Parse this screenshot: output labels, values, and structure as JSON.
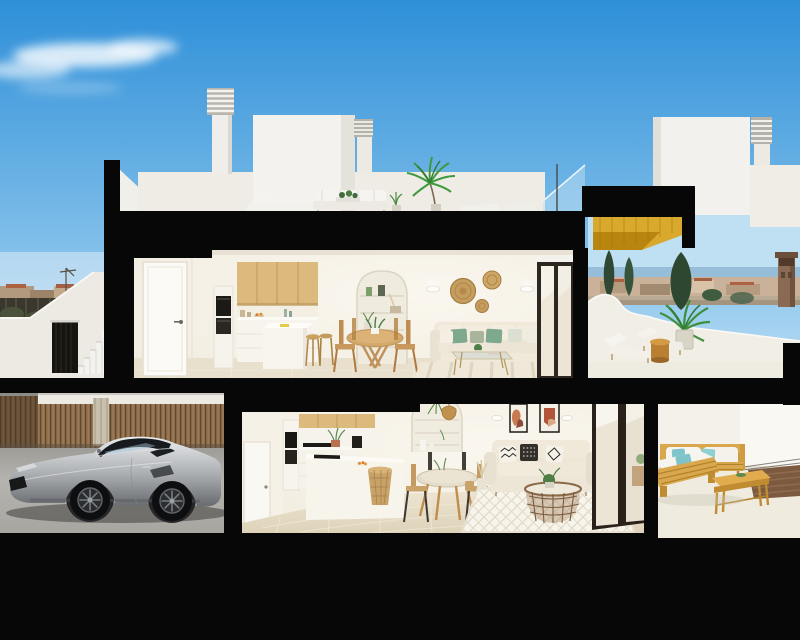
{
  "title": "Cross-section 3D render of a two-storey coastal apartment building",
  "palette": {
    "sky_top": "#2e8fd8",
    "sky_mid": "#7dbde9",
    "sky_horizon": "#cfe9f7",
    "structure_black": "#070707",
    "wall_cream": "#f2ede1",
    "wall_white": "#f3f1ea",
    "wood_cabinet": "#dcba7e",
    "pergola_gold": "#d9a92e",
    "terrace_wood": "#d9a84e",
    "teal_cushion": "#7fc4c9",
    "sage_cushion": "#7fa98f",
    "rattan": "#c49d5e",
    "car_silver": "#b9bcbe",
    "floor_beige": "#e6ddc8",
    "fence_wood": "#8d6c4a",
    "tree_green": "#2e4833",
    "sea_blue": "#8fb7d4",
    "town_tan": "#b29a7f",
    "terracotta_roof": "#ad6142"
  },
  "scene": {
    "sky": {
      "clouds": [
        "wispy-cloud-upper-left",
        "faint-streak"
      ]
    },
    "rooftop": {
      "objects": [
        "louvered-chimney",
        "louvered-chimney",
        "stair-bulkhead-volume",
        "roof-terrace-lounger",
        "roof-terrace-sofa",
        "potted-plant",
        "palm-plant",
        "glass-railing",
        "louvered-chimney-right-unit"
      ]
    },
    "upper_floor": {
      "rooms": [
        "kitchen",
        "dining-area",
        "living-room",
        "terrace"
      ],
      "objects": [
        "interior-door",
        "built-in-ovens",
        "wood-upper-cabinets",
        "kitchen-island",
        "bar-stools",
        "round-dining-table",
        "wood-chairs",
        "arched-shelf-niche",
        "wall-sconces",
        "rattan-wall-baskets",
        "cream-corner-sofa",
        "glass-coffee-table",
        "striped-rug",
        "sliding-glass-door",
        "gold-pergola",
        "sun-loungers",
        "round-side-table",
        "potted-palm"
      ]
    },
    "lower_floor": {
      "rooms": [
        "carport-garage",
        "kitchen",
        "dining-area",
        "living-room",
        "terrace"
      ],
      "objects": [
        "grey-sports-car",
        "timber-slat-fence",
        "built-in-ovens",
        "kitchen-island",
        "rattan-stool",
        "round-dining-table",
        "black-frame-chairs",
        "arched-shelf-niche",
        "pendant-lamp",
        "framed-artworks",
        "beige-sofa",
        "patterned-pillows",
        "rattan-coffee-table",
        "lattice-rug",
        "sliding-glass-door",
        "timber-outdoor-sofa",
        "timber-coffee-table",
        "doormat"
      ]
    },
    "left_exterior": [
      "town-skyline",
      "dark-fence",
      "external-staircase",
      "entrance-gate"
    ],
    "right_exterior": [
      "sea-horizon",
      "cypress-trees",
      "watchtower",
      "low-town-buildings"
    ]
  }
}
